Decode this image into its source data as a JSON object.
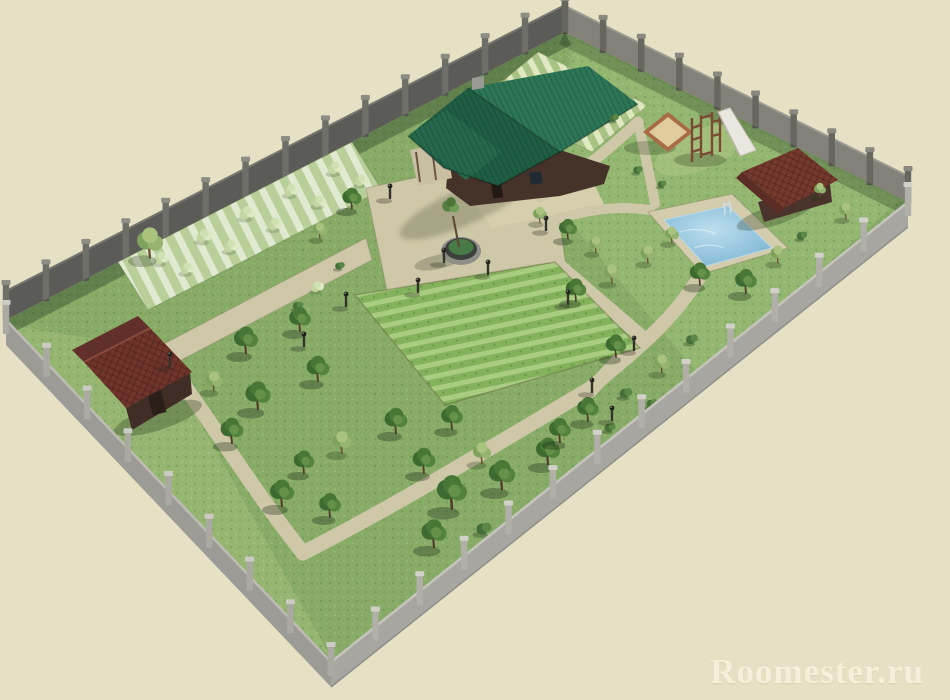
{
  "watermark": {
    "text": "Roomester.ru"
  },
  "scene": {
    "description": "3D rendered landscape design plan of a fenced rectangular garden plot viewed in perspective",
    "objects": [
      "main house with green roof",
      "paved terrace",
      "round planter with tree",
      "swimming pool with ladder",
      "pool house with brown tiled roof",
      "children sandbox",
      "climbing frame",
      "slide",
      "garden shed",
      "vegetable beds",
      "crop rows",
      "berry bush rows",
      "orchard trees",
      "lawn",
      "garden paths",
      "garden lamps",
      "perimeter fence"
    ],
    "colors": {
      "background": "#e6e1c5",
      "grass": "#88ac68",
      "grass_light": "#9dc077",
      "fence_dark": "#5b5b58",
      "fence_mid": "#82817a",
      "fence_light": "#a7a6a0",
      "fence_front2": "#9c9b95",
      "path": "#cfc8a8",
      "deck": "#d3ccad",
      "house_roof": "#2d7557",
      "house_roof_dark": "#1f5e44",
      "house_roof_gable": "#27684c",
      "house_wall": "#45332a",
      "shed_roof": "#6f352b",
      "pool_house_roof": "#753a2e",
      "pool_water": "#92c4dc",
      "sand": "#e0cb9c",
      "sandbox_frame": "#a96b44",
      "watermark_text": "#f8f4de"
    },
    "fence": {
      "edges": [
        {
          "name": "northwest",
          "x1": 6,
          "y1": 320,
          "x2": 565,
          "y2": 32,
          "posts": 14,
          "style": "back",
          "h": 31,
          "post": "#6f6f69",
          "cap": "#8d8d86"
        },
        {
          "name": "northeast",
          "x1": 565,
          "y1": 32,
          "x2": 908,
          "y2": 202,
          "posts": 9,
          "style": "back",
          "h": 27,
          "post": "#67665f",
          "cap": "#8b887f"
        },
        {
          "name": "southeast",
          "x1": 908,
          "y1": 202,
          "x2": 331,
          "y2": 662,
          "posts": 13,
          "style": "front",
          "h": 26,
          "post": "#b0afa8",
          "cap": "#d2d1c9"
        },
        {
          "name": "southwest",
          "x1": 6,
          "y1": 320,
          "x2": 331,
          "y2": 662,
          "posts": 8,
          "style": "front",
          "h": 26,
          "post": "#aaa9a2",
          "cap": "#cccbc3"
        }
      ]
    },
    "trees": {
      "format": [
        "x",
        "y",
        "scale",
        "symbol"
      ],
      "items": [
        [
          162,
          262,
          0.8,
          "pale"
        ],
        [
          205,
          240,
          0.85,
          "pale"
        ],
        [
          248,
          217,
          0.85,
          "pale"
        ],
        [
          292,
          194,
          0.8,
          "pale"
        ],
        [
          336,
          172,
          0.8,
          "pale"
        ],
        [
          188,
          272,
          0.75,
          "pale"
        ],
        [
          232,
          250,
          0.8,
          "pale"
        ],
        [
          276,
          228,
          0.8,
          "pale"
        ],
        [
          320,
          205,
          0.75,
          "pale"
        ],
        [
          362,
          184,
          0.7,
          "pale"
        ],
        [
          150,
          256,
          1.3,
          "lite"
        ],
        [
          318,
          290,
          0.7,
          "pale"
        ],
        [
          298,
          308,
          0.65,
          "shrub"
        ],
        [
          340,
          268,
          0.6,
          "shrub"
        ],
        [
          352,
          208,
          0.8,
          "dark"
        ],
        [
          320,
          238,
          0.7,
          "lite"
        ],
        [
          246,
          352,
          1.0,
          "dark"
        ],
        [
          300,
          330,
          0.9,
          "dark"
        ],
        [
          258,
          408,
          1.05,
          "dark"
        ],
        [
          318,
          380,
          0.95,
          "dark"
        ],
        [
          214,
          390,
          0.85,
          "lite"
        ],
        [
          232,
          442,
          0.95,
          "dark"
        ],
        [
          282,
          505,
          1.0,
          "dark"
        ],
        [
          330,
          516,
          0.9,
          "dark"
        ],
        [
          396,
          432,
          0.95,
          "dark"
        ],
        [
          452,
          428,
          0.9,
          "dark"
        ],
        [
          342,
          452,
          0.95,
          "lite"
        ],
        [
          304,
          472,
          0.85,
          "dark"
        ],
        [
          424,
          472,
          0.95,
          "dark"
        ],
        [
          482,
          462,
          0.9,
          "lite"
        ],
        [
          452,
          507,
          1.25,
          "dark"
        ],
        [
          502,
          488,
          1.1,
          "dark"
        ],
        [
          548,
          463,
          1.0,
          "dark"
        ],
        [
          434,
          546,
          1.05,
          "dark"
        ],
        [
          484,
          532,
          0.95,
          "shrub"
        ],
        [
          560,
          441,
          0.9,
          "dark"
        ],
        [
          576,
          300,
          0.85,
          "dark"
        ],
        [
          612,
          282,
          0.8,
          "lite"
        ],
        [
          648,
          262,
          0.75,
          "lite"
        ],
        [
          616,
          356,
          0.85,
          "dark"
        ],
        [
          588,
          420,
          0.9,
          "dark"
        ],
        [
          626,
          396,
          0.8,
          "shrub"
        ],
        [
          662,
          372,
          0.8,
          "lite"
        ],
        [
          692,
          342,
          0.75,
          "shrub"
        ],
        [
          610,
          430,
          0.7,
          "shrub"
        ],
        [
          652,
          406,
          0.7,
          "shrub"
        ],
        [
          700,
          284,
          0.85,
          "dark"
        ],
        [
          746,
          292,
          0.9,
          "dark"
        ],
        [
          778,
          262,
          0.75,
          "lite"
        ],
        [
          802,
          238,
          0.65,
          "shrub"
        ],
        [
          672,
          242,
          0.7,
          "lite"
        ],
        [
          638,
          172,
          0.6,
          "shrub"
        ],
        [
          662,
          186,
          0.55,
          "shrub"
        ],
        [
          820,
          196,
          0.6,
          "lite"
        ],
        [
          846,
          218,
          0.7,
          "lite"
        ],
        [
          614,
          120,
          0.6,
          "shrub"
        ],
        [
          540,
          222,
          0.7,
          "lite"
        ],
        [
          568,
          238,
          0.75,
          "dark"
        ],
        [
          596,
          252,
          0.7,
          "lite"
        ]
      ]
    },
    "lamps": [
      [
        390,
        198
      ],
      [
        444,
        262
      ],
      [
        488,
        274
      ],
      [
        418,
        292
      ],
      [
        346,
        306
      ],
      [
        568,
        304
      ],
      [
        634,
        350
      ],
      [
        592,
        392
      ],
      [
        304,
        346
      ],
      [
        170,
        366
      ],
      [
        546,
        230
      ],
      [
        612,
        420
      ]
    ]
  }
}
